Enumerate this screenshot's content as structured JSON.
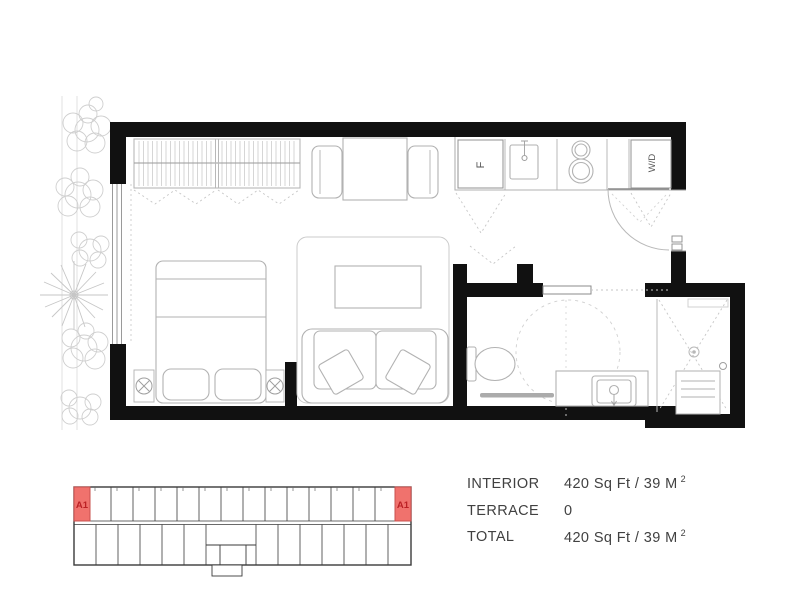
{
  "plan": {
    "labels": {
      "fridge": "F",
      "washer_dryer": "W/D"
    }
  },
  "keyplan": {
    "unit_label": "A1"
  },
  "stats": {
    "rows": [
      {
        "label": "INTERIOR",
        "value": "420 Sq Ft / 39 M",
        "sup": "2"
      },
      {
        "label": "TERRACE",
        "value": "0",
        "sup": ""
      },
      {
        "label": "TOTAL",
        "value": "420 Sq Ft / 39 M",
        "sup": "2"
      }
    ]
  },
  "colors": {
    "wall": "#111111",
    "furniture_line": "#b8b8b8",
    "plant_line": "#cccccc",
    "keyplan_line": "#3a3a3a",
    "highlight_fill": "#f0726d",
    "highlight_border": "#c8504e",
    "highlight_text": "#bb2125",
    "stats_text": "#414141"
  }
}
